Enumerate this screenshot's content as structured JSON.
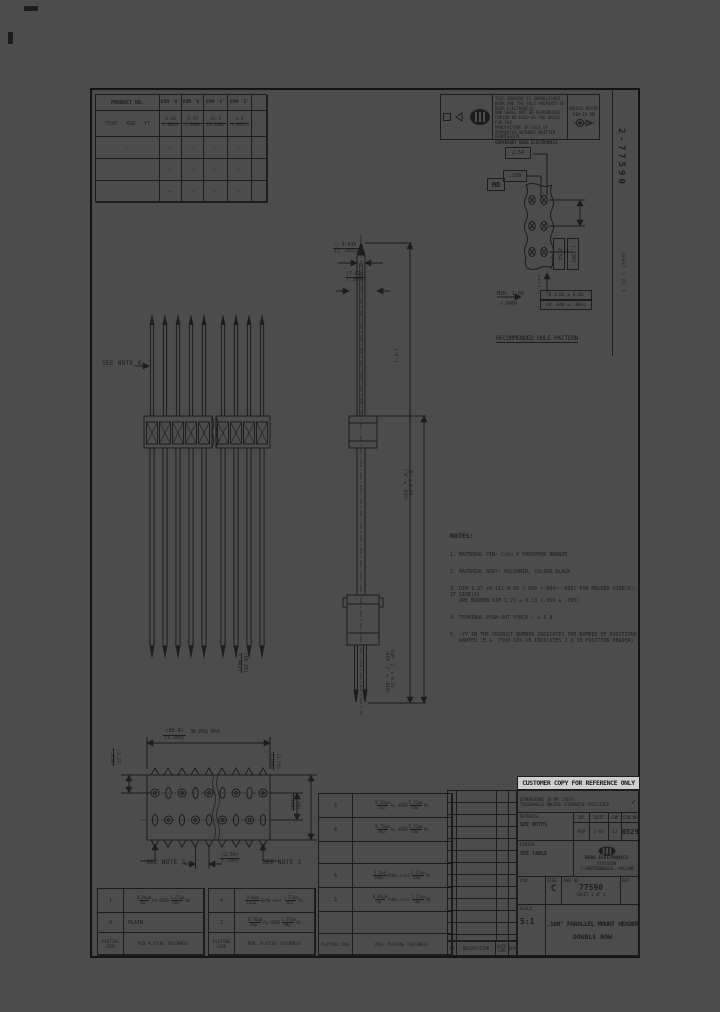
{
  "margin": {
    "vertical_dwg": "2-77590",
    "vertical_small": "SHEET 1 OF 1"
  },
  "product_table": {
    "h_product": "PRODUCT NO.",
    "h_a": "DIM 'A'",
    "h_b": "DIM 'B'",
    "h_c": "DIM 'C'",
    "h_z": "DIM 'Z'",
    "row": {
      "product": "7590 - XXX - YY",
      "a_top": "0.56",
      "a_bot": "(.022)",
      "b_top": "2.54",
      "b_bot": "(.100)",
      "c_top": "33.3",
      "c_bot": "(1.310)",
      "z_top": "1.4",
      "z_bot": "(.055)"
    },
    "dash": "—"
  },
  "cert": {
    "fine1": "THIS DRAWING IS UNPUBLISHED WORK AND THE SOLE PROPERTY OF BERG ELECTRONICS",
    "fine2": "AND SHALL NOT BE REPRODUCED, COPIED OR USED AS THE BASIS FOR THE",
    "fine3": "MANUFACTURE OR SALE OF APPARATUS WITHOUT WRITTEN PERMISSION.",
    "copyright": "COPYRIGHT BERG ELECTRONICS",
    "unless1": "UNLESS NOTED",
    "unless2": "DIM IN MM",
    "stamp": "MB"
  },
  "hole_pattern": {
    "pitch_mm": "2.54",
    "pitch_in": ".100",
    "r_mm": "2.54",
    "r_in": "(.100)",
    "min1": "MIN. 1.00",
    "min2": "(.040)",
    "dia1": "Ø 1.02 ± 0.08",
    "dia2": "(Ø .040 ± .003)",
    "caption": "RECOMMENDED HOLE PATTERN"
  },
  "front_view": {
    "see_note": "SEE NOTE 4",
    "tail_top": "(10.20)",
    "tail_bot": "(.402)"
  },
  "side_view": {
    "sq_top": "□ 0.635",
    "sq_bot": "(□ .025)",
    "w_top": "(7.62)",
    "w_bot": "(.300)",
    "c_label": "('C')",
    "b1": "'B' ± 0.38",
    "b2": "('B' ± .015)",
    "z1": "DIM 'Z' ± 0.25",
    "z2": "(DIM 'Z' ± .010)"
  },
  "notes": {
    "title": "NOTES:",
    "items": [
      "1. MATERIAL PIN: CuSn P PHOSPHOR BRONZE",
      "2. MATERIAL BODY: POLYAMID, COLOUR BLACK",
      "3. DIM 1.27 +0.11/-0.05 (.050 +.004/-.002) FOR MOLDED SIDE(S); IF SIDE(S)",
      "ARE BROKEN DIM 1.27 ± 0.13 (.050 ± .005)",
      "4. TERMINAL PUSH-OUT FORCE : ≥ 6 N",
      "5. -YY IN THE PRODUCT NUMBER INDICATES THE NUMBER OF POSITIONS",
      "WANTED (E.G. 7590-XXX-18 INDICATES 2 X 18 POSITION HEADER)"
    ]
  },
  "top_view": {
    "span_mm": "(88.9)",
    "span_in": "(3.500)",
    "span_note": "36 POS MAX",
    "row_mm": "(1.27)",
    "row_in": "(.050)",
    "pitch_mm": "(2.54)",
    "pitch_in": "(.100)",
    "width_mm": "(5.08)",
    "width_in": "(.200)",
    "see_note_l": "SEE NOTE 3",
    "bp_mm": "(2.54)",
    "bp_in": "(.100)",
    "see_note_r": "SEE NOTE 3"
  },
  "plating": {
    "t1": {
      "r1": {
        "code": "1",
        "d1t": "0.20μm",
        "d1b": "8μ″",
        "mid": "Au OVER",
        "d2t": "1.27μm",
        "d2b": "50μ″",
        "tail": "Ni"
      },
      "r2": {
        "code": "0",
        "plain": "PLAIN"
      },
      "foot_code": "PLATING CODE",
      "foot_desc": "MIN PLATING THICKNESS"
    },
    "t2": {
      "r1": {
        "code": "4",
        "d1t": "3.8μm",
        "d1b": "150μ″",
        "mid": "SnPb over",
        "d2t": "1.27μm",
        "d2b": "50μ″",
        "tail": "Ni"
      },
      "r2": {
        "code": "2",
        "d1t": "0.76μm",
        "d1b": "30μ″",
        "mid": "Au OVER",
        "d2t": "1.27μm",
        "d2b": "50μ″",
        "tail": "Ni"
      },
      "foot_code": "PLATING CODE",
      "foot_desc": "MIN. PLATING THICKNESS"
    },
    "t3": {
      "r1": {
        "code": "3",
        "d1t": "0.38μm",
        "d1b": "15μ″",
        "mid": "Au OVER",
        "d2t": "1.27μm",
        "d2b": "50μ″",
        "tail": "Ni"
      },
      "r2": {
        "code": "8",
        "d1t": "0.76μm",
        "d1b": "30μ″",
        "mid": "Au OVER",
        "d2t": "1.27μm",
        "d2b": "50μ″",
        "tail": "Ni"
      },
      "r3": {
        "code": "6",
        "d1t": "2.5μm",
        "d1b": "100μ″",
        "mid": "PdNi over",
        "d2t": "1.27μm",
        "d2b": "50μ″",
        "tail": "Ni"
      },
      "r4": {
        "code": "5",
        "d1t": "0.05μm",
        "d1b": "2μ″",
        "mid": "PdNi over",
        "d2t": "1.27μm",
        "d2b": "50μ″",
        "tail": "Ni"
      },
      "foot_code": "PLATING CODE",
      "foot_desc": "MIN. PLATING THICKNESS"
    }
  },
  "title_block": {
    "banner": "CUSTOMER COPY FOR REFERENCE ONLY",
    "tol1": "DIMENSIONS IN MM (INCH)",
    "tol2": "TOLERANCES UNLESS OTHERWISE SPECIFIED",
    "check": "✓",
    "material_label": "MATERIAL",
    "material": "SEE NOTES",
    "finish_label": "FINISH",
    "finish": "SEE TABLE",
    "dr_label": "DR",
    "dr": "MvB",
    "date_label": "DATE",
    "date": "5-94",
    "chk_label": "CHK",
    "chk": "CJ",
    "ecn_label": "ECN NO",
    "ecn": "0529",
    "cad_label": "CAD",
    "size_label": "SIZE",
    "size": "C",
    "dwg_label": "DWG NO",
    "dwg_no": "77590",
    "rev_label": "REV",
    "sheet": "SHEET 1 OF 1",
    "scale_label": "SCALE",
    "scale": "5:1",
    "title_line1": ".100″ PARALLEL MOUNT HEADER",
    "title_line2": "DOUBLE ROW",
    "logo_line1": "BERG ELECTRONICS",
    "logo_line2": "DIVISION",
    "logo_line3": "'S-HERTOGENBOSCH - HOLLAND",
    "rev_foot_c1": "NR",
    "rev_foot_c2": "DESCRIPTION",
    "rev_foot_c3": "DATE  CHK",
    "rev_foot_c4": "APP"
  }
}
